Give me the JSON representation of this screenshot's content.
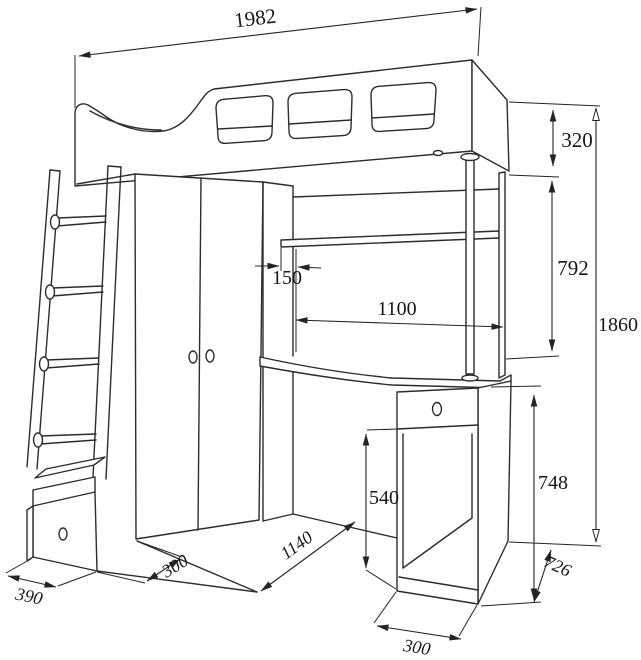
{
  "drawing": {
    "title": "loft-bed-with-desk-dimension-drawing",
    "units": "mm",
    "dims": {
      "total_width": "1982",
      "bed_box_height": "320",
      "bed_clearance": "792",
      "total_height": "1860",
      "shelf_offset": "150",
      "shelf_width": "1100",
      "knee_space_height": "540",
      "desk_height": "748",
      "desk_side_depth": "726",
      "floor_span": "1140",
      "wardrobe_base_depth": "300",
      "ladder_unit_depth": "390",
      "pedestal_width": "300"
    }
  }
}
